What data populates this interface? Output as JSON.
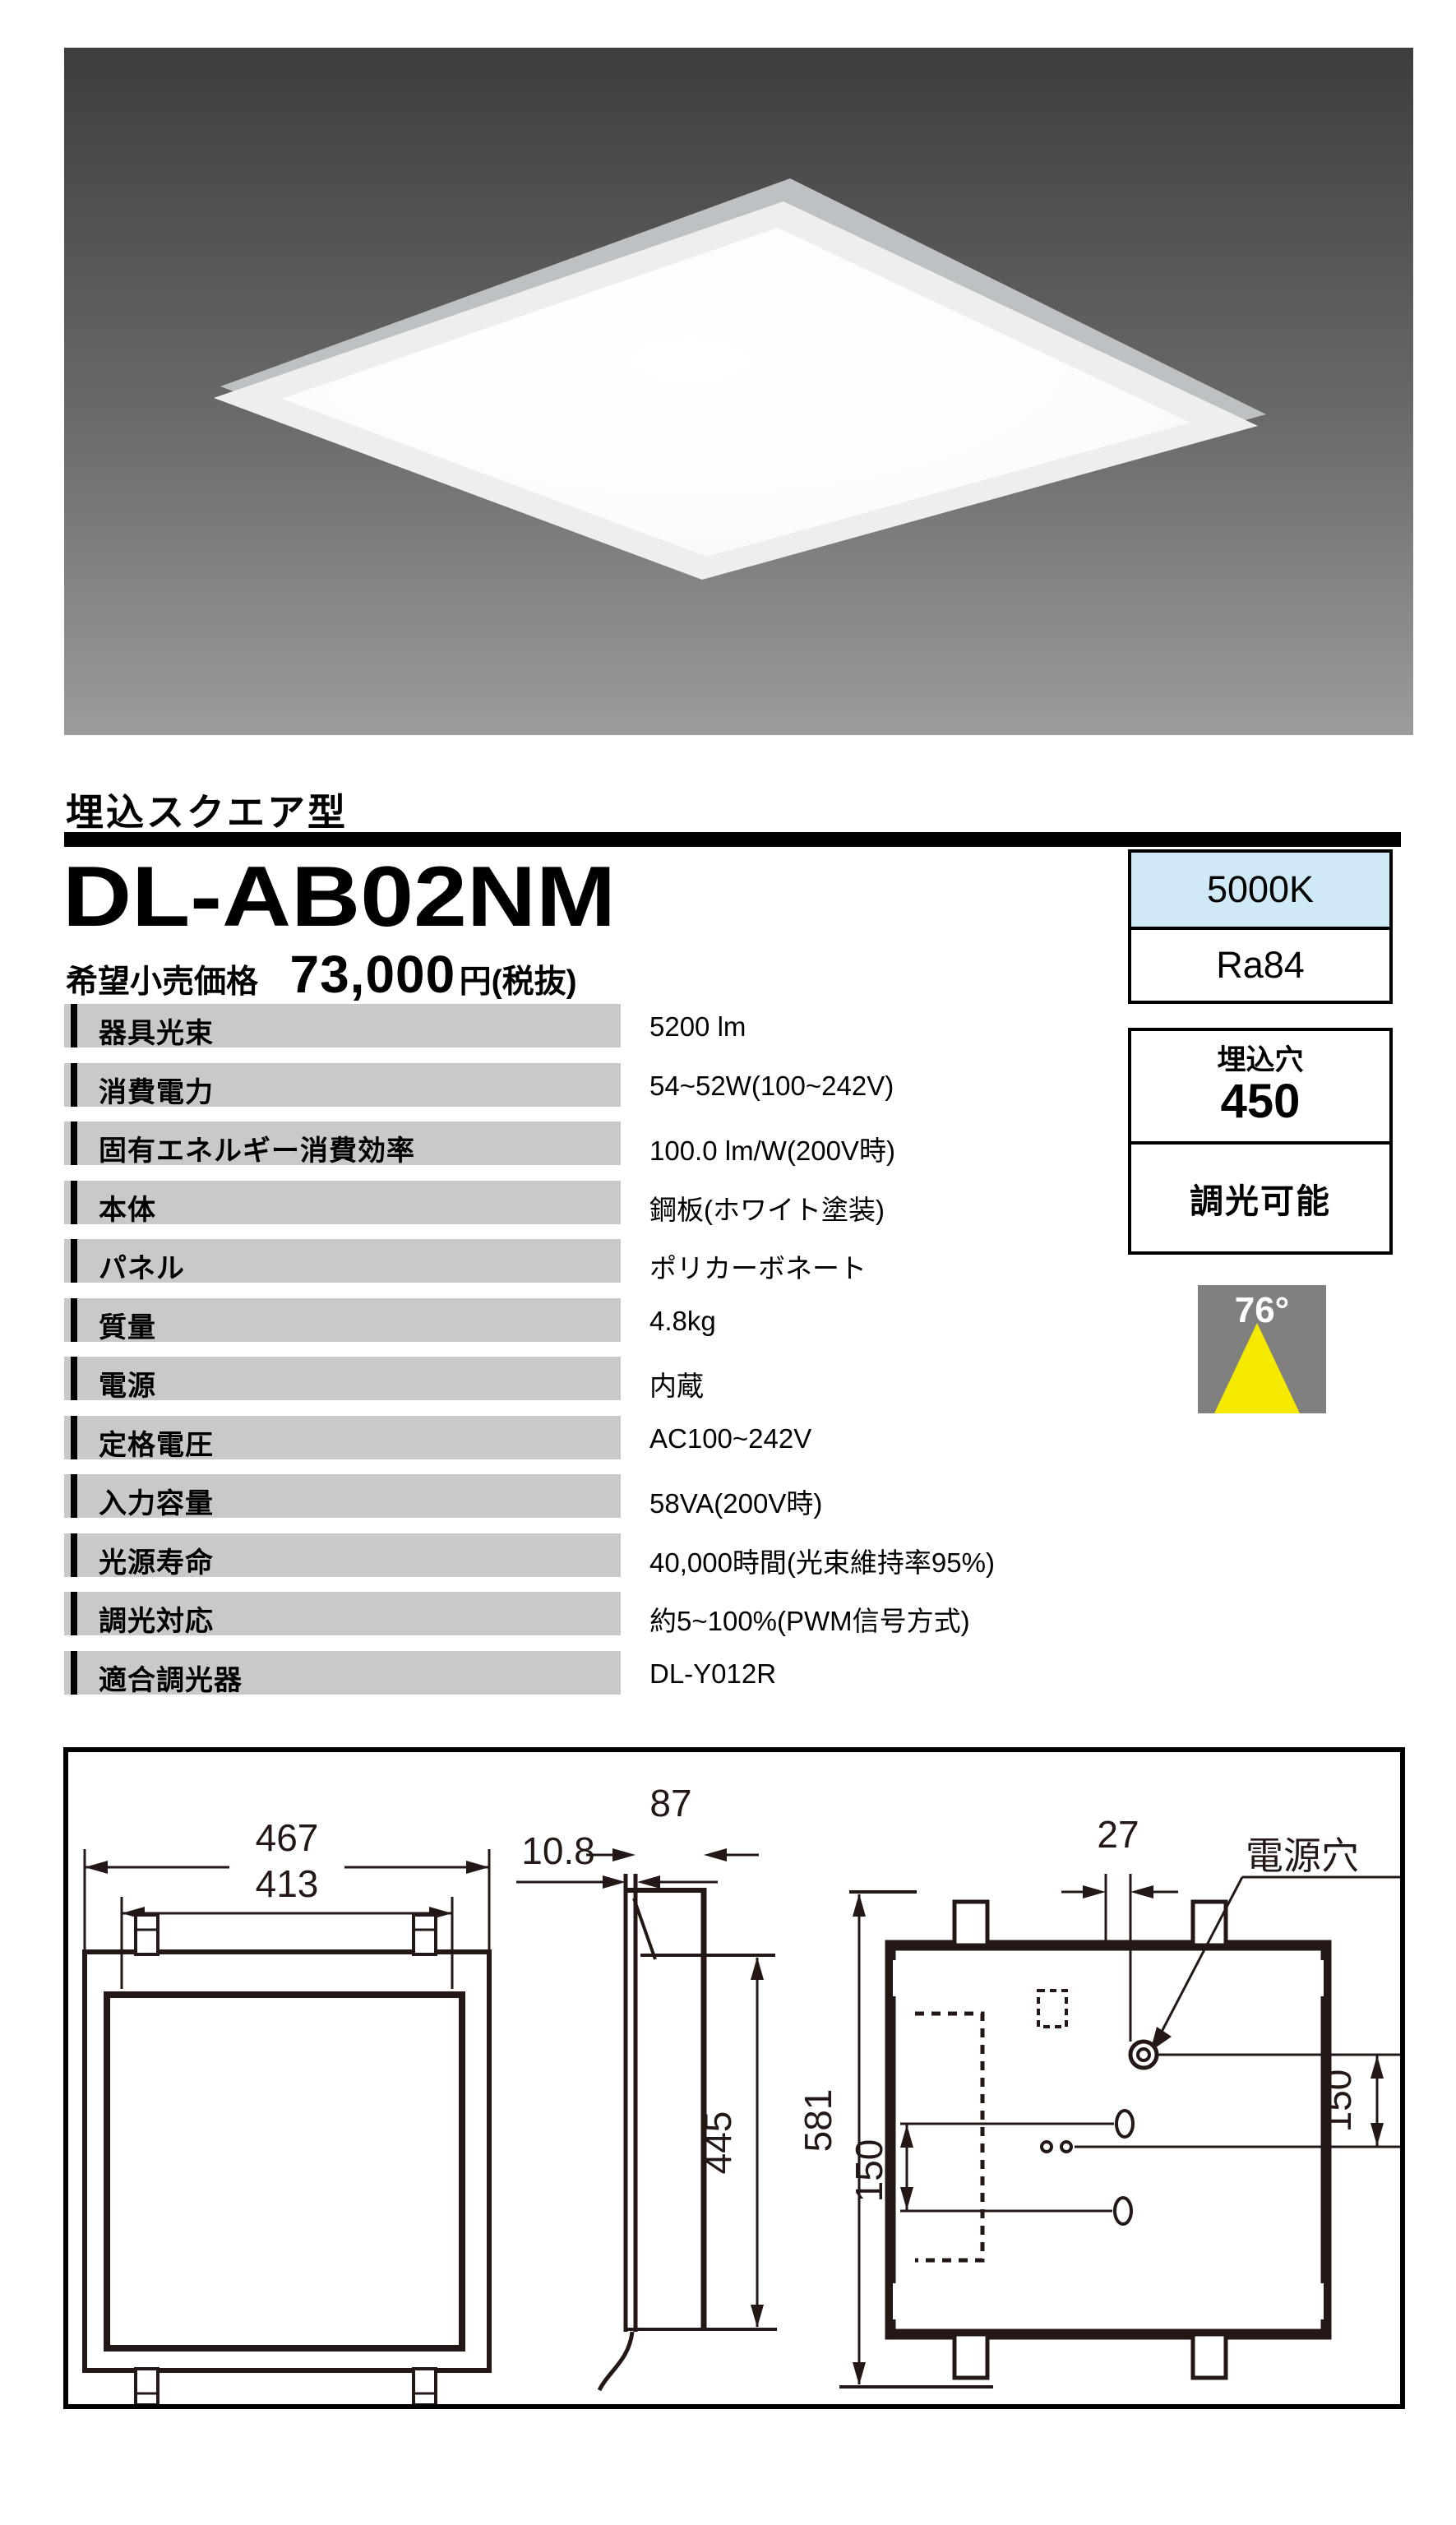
{
  "header": {
    "category": "埋込スクエア型",
    "model": "DL-AB02NM",
    "price_label": "希望小売価格",
    "price_value": "73,000",
    "price_suffix": "円(税抜)"
  },
  "badges": {
    "color_temp": "5000K",
    "cri": "Ra84",
    "cutout_label": "埋込穴",
    "cutout_value": "450",
    "dimmable_label": "調光可能",
    "beam_angle": "76°"
  },
  "specs": [
    {
      "label": "器具光束",
      "value": "5200 lm"
    },
    {
      "label": "消費電力",
      "value": "54~52W(100~242V)"
    },
    {
      "label": "固有エネルギー消費効率",
      "value": "100.0 lm/W(200V時)"
    },
    {
      "label": "本体",
      "value": "鋼板(ホワイト塗装)"
    },
    {
      "label": "パネル",
      "value": "ポリカーボネート"
    },
    {
      "label": "質量",
      "value": "4.8kg"
    },
    {
      "label": "電源",
      "value": "内蔵"
    },
    {
      "label": "定格電圧",
      "value": "AC100~242V"
    },
    {
      "label": "入力容量",
      "value": "58VA(200V時)"
    },
    {
      "label": "光源寿命",
      "value": "40,000時間(光束維持率95%)"
    },
    {
      "label": "調光対応",
      "value": "約5~100%(PWM信号方式)"
    },
    {
      "label": "適合調光器",
      "value": "DL-Y012R"
    }
  ],
  "drawing": {
    "front": {
      "outer_width": "467",
      "inner_width": "413"
    },
    "side": {
      "flange_thickness": "10.8",
      "depth": "87",
      "height": "445"
    },
    "back": {
      "hole_offset": "27",
      "power_hole_label": "電源穴",
      "right_spacing": "150",
      "left_spacing": "150",
      "overall_height": "581"
    }
  },
  "colors": {
    "color_temp_bg": "#cfe9f7",
    "beam_icon_bg": "#808080",
    "beam_yellow": "#f5e900",
    "spec_row_bg": "#c9c9c9",
    "line_ink": "#231815"
  }
}
